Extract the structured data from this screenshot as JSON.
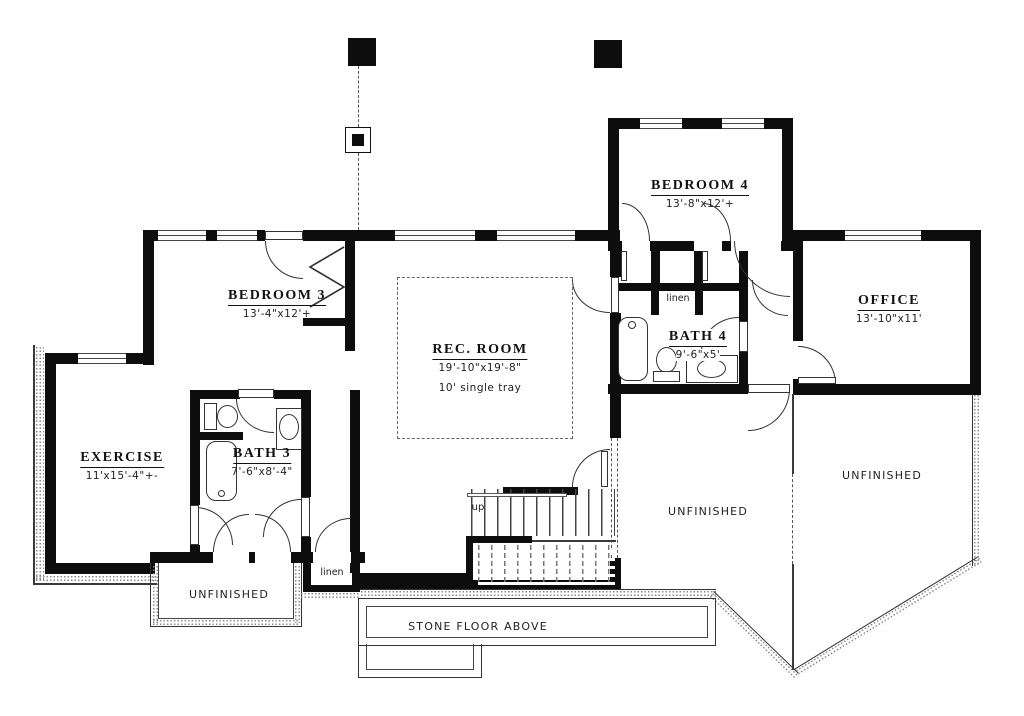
{
  "plan": {
    "title": "Basement Floor Plan",
    "rooms": {
      "bedroom3": {
        "name": "BEDROOM 3",
        "dims": "13'-4\"x12'+"
      },
      "exercise": {
        "name": "EXERCISE",
        "dims": "11'x15'-4\"+-"
      },
      "bath3": {
        "name": "BATH 3",
        "dims": "7'-6\"x8'-4\""
      },
      "rec_room": {
        "name": "REC. ROOM",
        "dims": "19'-10\"x19'-8\"",
        "note": "10' single tray"
      },
      "bedroom4": {
        "name": "BEDROOM 4",
        "dims": "13'-8\"x12'+"
      },
      "bath4": {
        "name": "BATH 4",
        "dims": "9'-6\"x5'"
      },
      "office": {
        "name": "OFFICE",
        "dims": "13'-10\"x11'"
      }
    },
    "areas": {
      "unfinished_bottom_left": "UNFINISHED",
      "unfinished_center": "UNFINISHED",
      "unfinished_right": "UNFINISHED",
      "stone_floor": "STONE FLOOR ABOVE"
    },
    "closets": {
      "linen_bath4": "linen",
      "linen_hall": "linen"
    },
    "stairs": {
      "up_label": "up"
    },
    "colors": {
      "wall": "#0d0d0d",
      "line": "#333333",
      "stipple": "#9a9a9a",
      "dash": "#555555"
    }
  }
}
